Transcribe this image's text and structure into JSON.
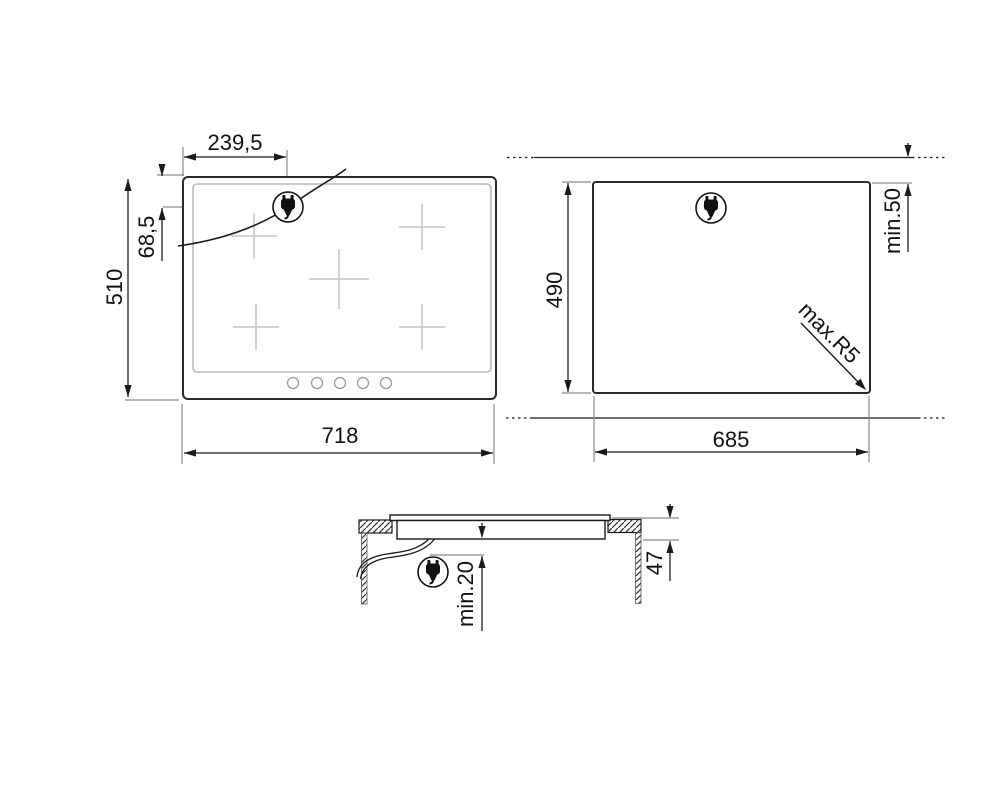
{
  "drawing": {
    "type": "installation-dimension-diagram",
    "line_color": "#1a1a1a",
    "extension_line_color": "#8a8a8a",
    "burner_cross_color": "#c4c4c4",
    "background": "#ffffff"
  },
  "dimensions": {
    "front_view": {
      "width": "718",
      "height": "510",
      "plug_offset_x": "239,5",
      "plug_offset_y": "68,5"
    },
    "cutout_view": {
      "width": "685",
      "height": "490",
      "rear_clearance": "min.50",
      "corner_radius": "max.R5"
    },
    "section_view": {
      "built_in_depth": "47",
      "bottom_clearance": "min.20"
    }
  },
  "icons": {
    "plug": "power-plug-icon"
  }
}
